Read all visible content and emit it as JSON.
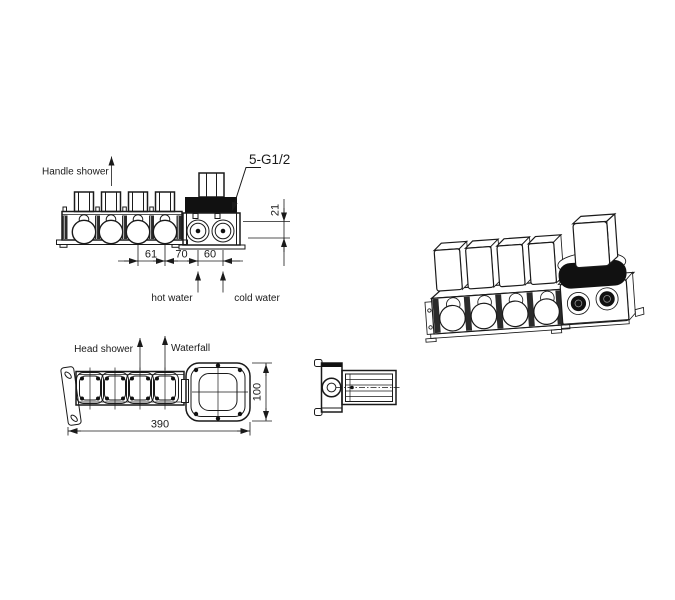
{
  "drawing": {
    "labels": {
      "handle_shower": "Handle shower",
      "hot_water": "hot water",
      "cold_water": "cold water",
      "head_shower": "Head shower",
      "waterfall": "Waterfall",
      "thread_spec": "5-G1/2"
    },
    "dimensions": {
      "cartridge_pitch": "61",
      "cartridge_to_hot_port": "70",
      "hot_to_cold_port": "60",
      "port_depth": "21",
      "total_length": "390",
      "body_height": "100"
    },
    "colors": {
      "line": "#1a1a1a",
      "background": "#ffffff",
      "solid_fill": "#111111"
    }
  }
}
